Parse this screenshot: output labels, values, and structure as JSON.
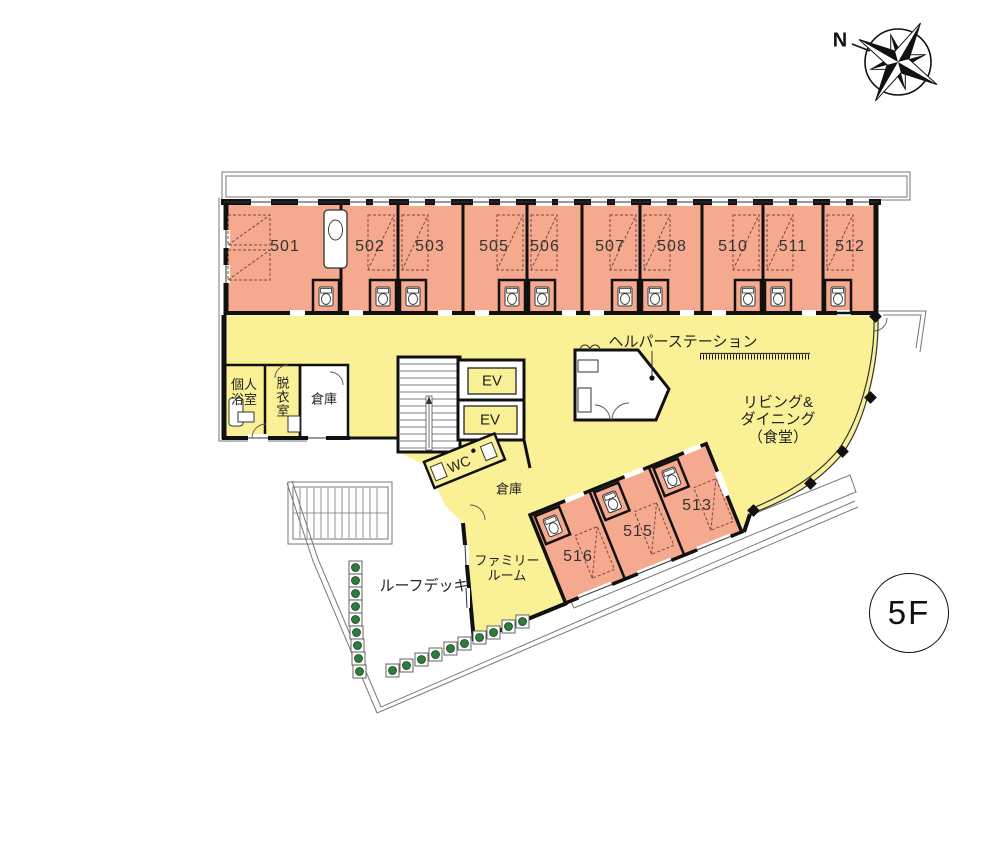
{
  "title": "5F floor plan",
  "compass": {
    "label": "N"
  },
  "floor_badge": {
    "label": "5F"
  },
  "colors": {
    "room_fill": "#F5A98E",
    "common_fill": "#FAF096",
    "wall": "#111111",
    "thin_outline": "#666666",
    "planter_green": "#2E7D3C"
  },
  "rooms_top": [
    {
      "number": "501"
    },
    {
      "number": "502"
    },
    {
      "number": "503"
    },
    {
      "number": "505"
    },
    {
      "number": "506"
    },
    {
      "number": "507"
    },
    {
      "number": "508"
    },
    {
      "number": "510"
    },
    {
      "number": "511"
    },
    {
      "number": "512"
    }
  ],
  "rooms_wing": [
    {
      "number": "516"
    },
    {
      "number": "515"
    },
    {
      "number": "513"
    }
  ],
  "labels": {
    "helper_station": "ヘルパーステーション",
    "living_line1": "リビング&",
    "living_line2": "ダイニング",
    "living_line3": "（食堂）",
    "bath_line1": "個人",
    "bath_line2": "浴室",
    "changing_room": "脱衣室",
    "storage_a": "倉庫",
    "storage_b": "倉庫",
    "ev_a": "EV",
    "ev_b": "EV",
    "wc": "WC",
    "family_line1": "ファミリー",
    "family_line2": "ルーム",
    "roof_deck": "ルーフデッキ"
  }
}
